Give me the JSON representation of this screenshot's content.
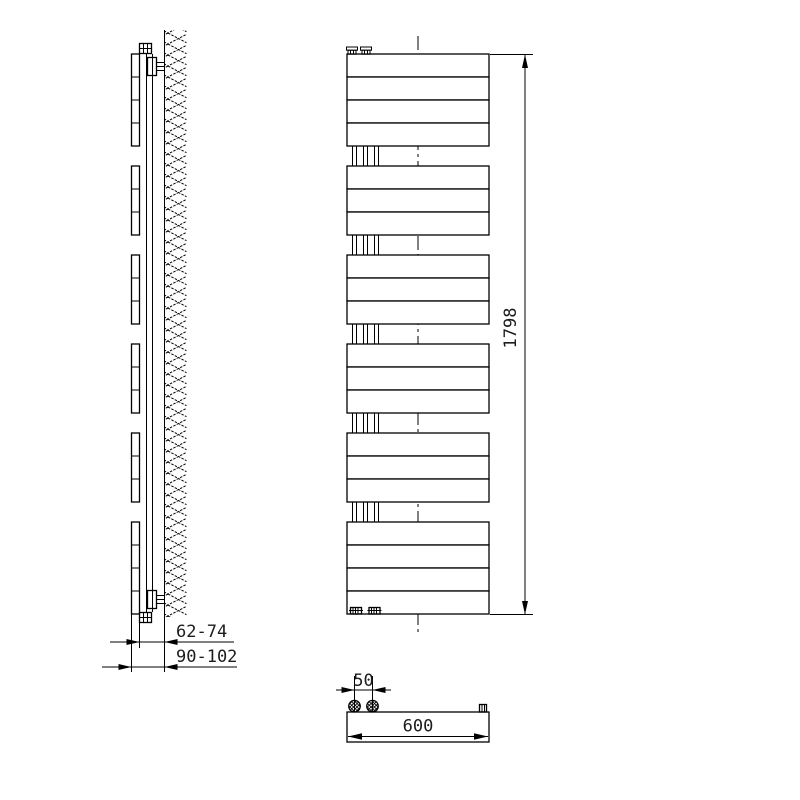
{
  "figure": {
    "type": "technical-drawing",
    "subject": "wall-mounted vertical towel radiator shown in side, front and top orthographic views",
    "colors": {
      "background": "#ffffff",
      "line": "#000000",
      "text": "#1c1c1c"
    },
    "front_view": {
      "bar_groups": [
        4,
        3,
        3,
        3,
        3,
        4
      ],
      "bars_total": 20
    },
    "dimensions": {
      "wall_to_panel": "62-74",
      "wall_to_front": "90-102",
      "height": "1798",
      "connection_spacing": "50",
      "width": "600"
    }
  }
}
